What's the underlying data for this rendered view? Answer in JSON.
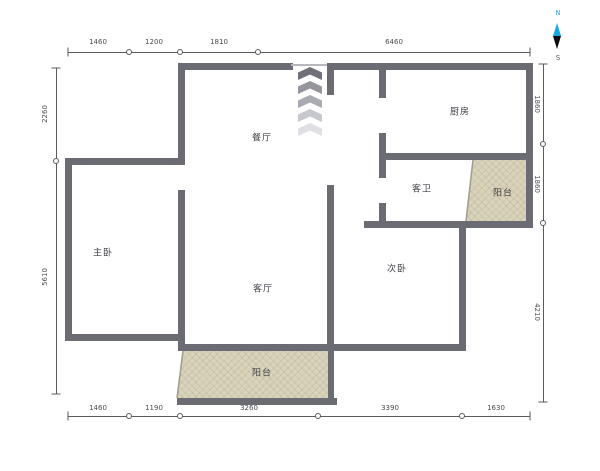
{
  "plan": {
    "rooms": {
      "dining": "餐厅",
      "kitchen": "厨房",
      "guest_bathroom": "客卫",
      "balcony_right": "阳台",
      "master_bedroom": "主卧",
      "living_room": "客厅",
      "second_bedroom": "次卧",
      "balcony_bottom": "阳台"
    },
    "dimensions": {
      "top": [
        "1460",
        "1200",
        "1810",
        "6460"
      ],
      "bottom": [
        "1460",
        "1190",
        "3260",
        "3390",
        "1630"
      ],
      "left": [
        "2260",
        "5610"
      ],
      "right": [
        "1860",
        "1860",
        "4210"
      ]
    },
    "compass": {
      "north": "N",
      "south": "S"
    },
    "colors": {
      "wall": "#6a6b73",
      "balcony_fill": "#d8d3ba",
      "balcony_hatch": "#948e6e",
      "dimension": "#4b4b52",
      "compass_north": "#2bb3ee",
      "compass_needle_top": "#18a8e0",
      "compass_needle_bottom": "#0c0c10"
    }
  }
}
